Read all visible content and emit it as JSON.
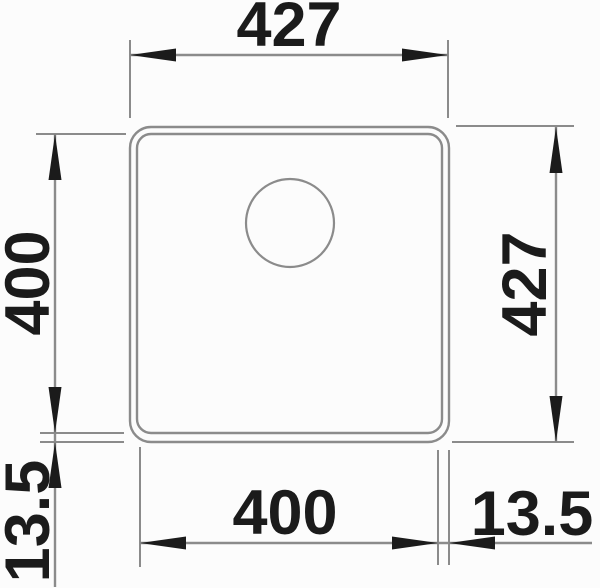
{
  "drawing": {
    "title": "Sink top-view dimension drawing",
    "dims": {
      "top_width": "427",
      "left_height": "400",
      "left_rim": "13.5",
      "right_height": "427",
      "bottom_width": "400",
      "bottom_rim": "13.5"
    },
    "colors": {
      "line": "#8b8b8b",
      "ink": "#1b1b1b",
      "background": "#fcfcfc"
    }
  }
}
